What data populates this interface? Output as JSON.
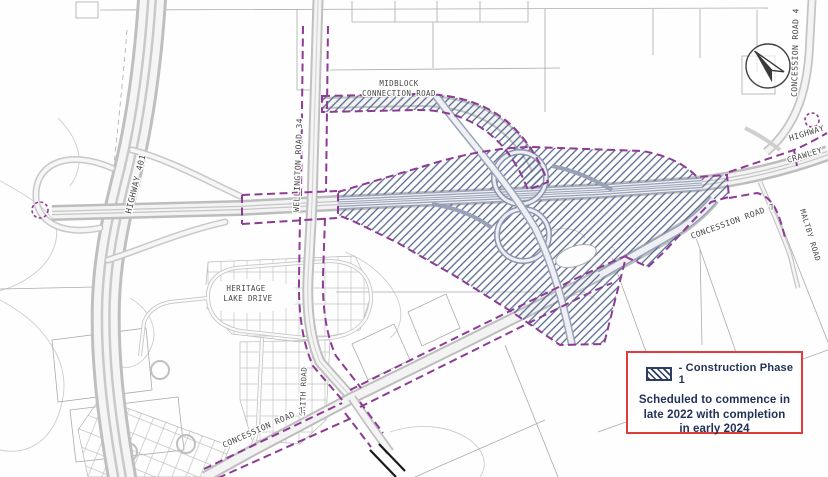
{
  "legend": {
    "swatch_label": "- Construction Phase 1",
    "schedule_lines": [
      "Scheduled to commence in",
      "late 2022 with completion",
      "in early 2024"
    ],
    "border_color": "#e13c3c",
    "text_color": "#223258",
    "hatch_color": "#2b3d66"
  },
  "map": {
    "construction_limit_color": "#8d3b94",
    "construction_hatch_color": "#56688f",
    "north_arrow_icon": "north-arrow",
    "labels": {
      "highway_401": "HIGHWAY 401",
      "wellington_road_34": "WELLINGTON ROAD 34",
      "midblock_line1": "MIDBLOCK",
      "midblock_line2": "CONNECTION ROAD",
      "concession_road_4": "CONCESSION ROAD 4",
      "highway_right": "HIGHWAY",
      "crawley": "CRAWLEY",
      "concession_road_east": "CONCESSION ROAD 7",
      "maltby_road": "MALTBY ROAD",
      "heritage_line1": "HERITAGE",
      "heritage_line2": "LAKE DRIVE",
      "smith_road": "SMITH ROAD",
      "concession_road_south": "CONCESSION ROAD 7"
    }
  }
}
